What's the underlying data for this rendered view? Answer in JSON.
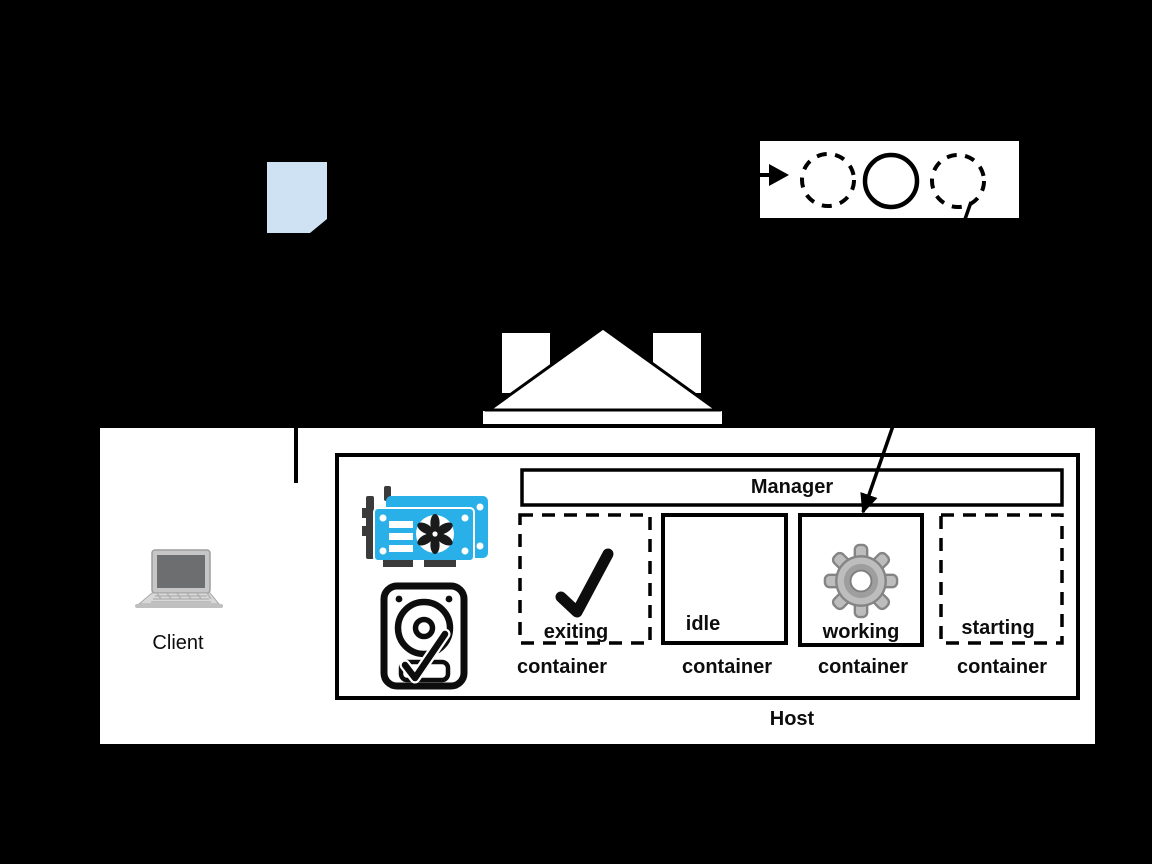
{
  "palette": {
    "background": "#000000",
    "box_white": "#ffffff",
    "line_black": "#000000",
    "document_fill": "#cfe2f3",
    "gpu_blue": "#29b0e8",
    "gear_gray": "#bdbdbd",
    "laptop_gray": "#c9c9c9"
  },
  "client": {
    "label": "Client"
  },
  "flow_box": {
    "circles": [
      {
        "style": "dashed"
      },
      {
        "style": "solid"
      },
      {
        "style": "dashed"
      }
    ]
  },
  "host": {
    "label": "Host",
    "manager_label": "Manager",
    "containers": [
      {
        "state": "exiting",
        "caption": "container",
        "border": "dashed",
        "icon": "checkmark-icon"
      },
      {
        "state": "idle",
        "caption": "container",
        "border": "solid",
        "icon": ""
      },
      {
        "state": "working",
        "caption": "container",
        "border": "solid",
        "icon": "gear-icon"
      },
      {
        "state": "starting",
        "caption": "container",
        "border": "dashed",
        "icon": ""
      }
    ]
  }
}
